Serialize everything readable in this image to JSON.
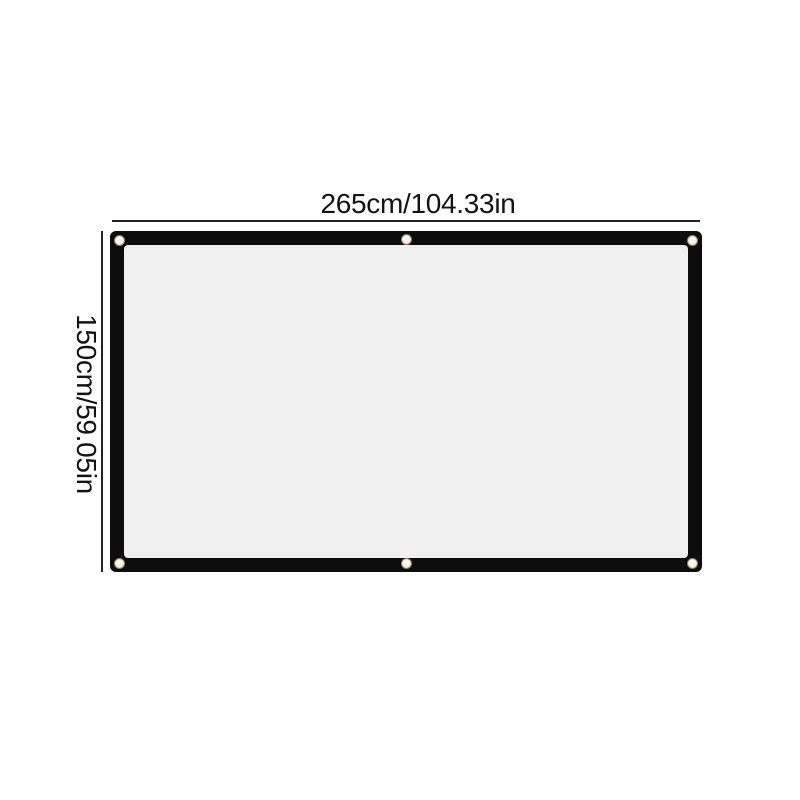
{
  "dimensions": {
    "width_label": "265cm/104.33in",
    "height_label": "150cm/59.05in"
  },
  "screen": {
    "grommet_count": 6
  },
  "colors": {
    "background": "#ffffff",
    "frame": "#0d0d0d",
    "surface": "#f0f0f1",
    "dimension_line": "#222222",
    "label_text": "#131313",
    "grommet_fill": "#f7efdd",
    "grommet_ring": "#8d8263"
  }
}
